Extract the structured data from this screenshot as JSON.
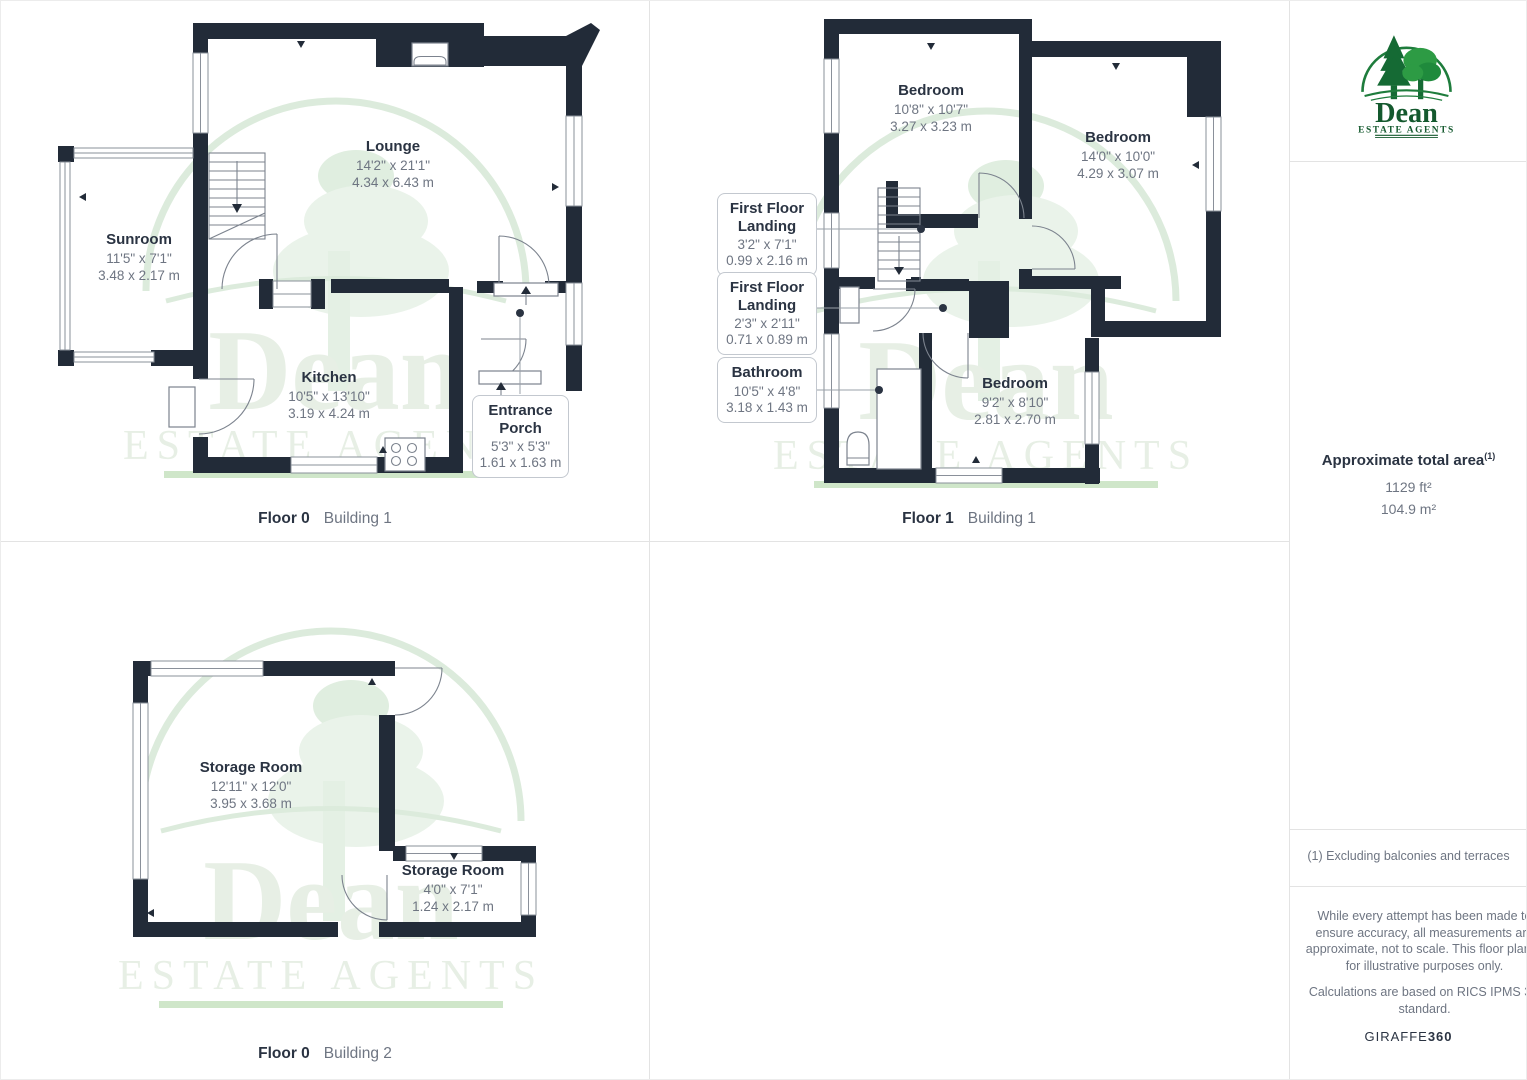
{
  "watermark": {
    "brand": "Dean",
    "tagline": "ESTATE AGENTS"
  },
  "colors": {
    "wall": "#222b38",
    "line_gray": "#7c838e",
    "text_dark": "#2a3342",
    "text_gray": "#6e7582",
    "logo_green_dark": "#14592e",
    "logo_green": "#1e7c3c",
    "logo_green_light": "#2d9b44",
    "watermark_green": "#e7efe5"
  },
  "panels": {
    "floor0_building1": {
      "caption": {
        "floor": "Floor 0",
        "building": "Building 1"
      },
      "rooms": {
        "lounge": {
          "name": "Lounge",
          "imperial": "14'2\" x 21'1\"",
          "metric": "4.34 x 6.43 m"
        },
        "sunroom": {
          "name": "Sunroom",
          "imperial": "11'5\" x 7'1\"",
          "metric": "3.48 x 2.17 m"
        },
        "kitchen": {
          "name": "Kitchen",
          "imperial": "10'5\" x 13'10\"",
          "metric": "3.19 x 4.24 m"
        },
        "entrance_porch": {
          "name": "Entrance\nPorch",
          "imperial": "5'3\" x 5'3\"",
          "metric": "1.61 x 1.63 m"
        }
      }
    },
    "floor1_building1": {
      "caption": {
        "floor": "Floor 1",
        "building": "Building 1"
      },
      "rooms": {
        "bedroom1": {
          "name": "Bedroom",
          "imperial": "10'8\" x 10'7\"",
          "metric": "3.27 x 3.23 m"
        },
        "bedroom2": {
          "name": "Bedroom",
          "imperial": "14'0\" x 10'0\"",
          "metric": "4.29 x 3.07 m"
        },
        "bedroom3": {
          "name": "Bedroom",
          "imperial": "9'2\" x 8'10\"",
          "metric": "2.81 x 2.70 m"
        },
        "landing1": {
          "name": "First Floor\nLanding",
          "imperial": "3'2\" x 7'1\"",
          "metric": "0.99 x 2.16 m"
        },
        "landing2": {
          "name": "First Floor\nLanding",
          "imperial": "2'3\" x 2'11\"",
          "metric": "0.71 x 0.89 m"
        },
        "bathroom": {
          "name": "Bathroom",
          "imperial": "10'5\" x 4'8\"",
          "metric": "3.18 x 1.43 m"
        }
      }
    },
    "floor0_building2": {
      "caption": {
        "floor": "Floor 0",
        "building": "Building 2"
      },
      "rooms": {
        "storage1": {
          "name": "Storage Room",
          "imperial": "12'11\" x 12'0\"",
          "metric": "3.95 x 3.68 m"
        },
        "storage2": {
          "name": "Storage Room",
          "imperial": "4'0\" x 7'1\"",
          "metric": "1.24 x 2.17 m"
        }
      }
    }
  },
  "sidebar": {
    "logo": {
      "brand": "Dean",
      "tagline": "ESTATE AGENTS"
    },
    "area": {
      "title": "Approximate total area",
      "superscript": "(1)",
      "imperial": "1129 ft²",
      "metric": "104.9 m²"
    },
    "footnote": "(1) Excluding balconies and terraces",
    "disclaimer": "While every attempt has been made to ensure accuracy, all measurements are approximate, not to scale. This floor plan is for illustrative purposes only.",
    "standard": "Calculations are based on RICS IPMS 3C standard.",
    "brand_mark": {
      "name": "GIRAFFE",
      "suffix": "360"
    }
  }
}
